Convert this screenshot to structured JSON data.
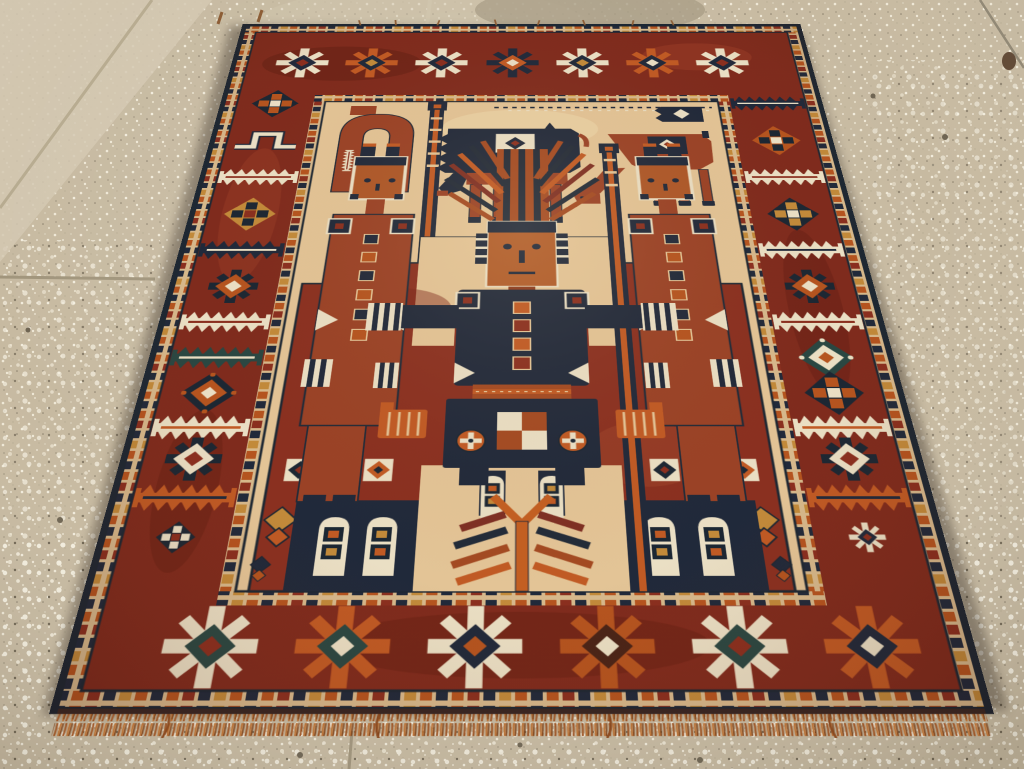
{
  "scene": {
    "type": "photograph",
    "subject": "Antique tribal pictorial rug displayed on a speckled terrazzo floor",
    "description": "A red-ground hand-knotted pictorial rug, seen in perspective with its lower edge nearest the camera, lying on a beige terrazzo concrete floor",
    "floor": {
      "material": "terrazzo concrete",
      "appearance": "beige ground densely flecked with small light stone chips",
      "features": [
        "diagonal grout seam at upper left",
        "horizontal seam at mid left",
        "diagonal seam at upper right",
        "short seam at lower center",
        "small dark brown stain near upper right corner",
        "smooth lighter patch at upper left"
      ]
    },
    "rug": {
      "description": "Pictorial tribal rug with ivory field, brick-red central panel, figural scene and multiple geometric borders",
      "edges": {
        "selvage": "dark indigo overcast edge",
        "top_fringe": "sparse short tufts",
        "bottom_fringe": "orange-brown knotted fringe"
      },
      "guard_stripes": "rows of small alternating colored squares",
      "main_border": {
        "ground": "brick red",
        "top_row": "seven eight-armed snowflake stars",
        "bottom_row": "six large snowflake stars in ivory, orange and teal",
        "side_columns": "stacked serrated comb bars, diamond rosettes, hooked meanders, eight-point stars and diamond medallions"
      },
      "field": {
        "ground": "ivory",
        "upper_scene": {
          "left_motif": "rust arch with white comb",
          "animals": [
            "dark indigo horse with ivory saddle blanket and rust legs",
            "rust quadruped with indigo saddle patch and lowered head"
          ],
          "detail": "dotted warp line across the top of the field"
        },
        "central_panel": {
          "ground": "deep brick red",
          "central_figure": "frontal standing figure with orange face, radiating feather headdress, dark indigo torso with orange button column, outstretched arms with striped cuffs, checkered apron and two orange wheel rosettes",
          "attendants": "two flanking box-headed figures in rust robes grasping vertical striped poles",
          "poles": "two ladder-like striped standards",
          "lower_scene": "ivory arched boot shapes on indigo bands flanking a central tree with mirrored herringbone fronds",
          "scatter_motifs": [
            "ivory framed diamond squares",
            "gold double diamonds",
            "small indigo quatrefoil dots"
          ]
        }
      }
    }
  },
  "palette": {
    "floor_base": "#c7baa1",
    "floor_smooth": "#d6cbb4",
    "floor_speckle": "#efe8d6",
    "floor_speckle_dark": "#847a66",
    "grout": "#9c9178",
    "stain": "#5e4632",
    "selvage": "#1c2733",
    "guard_ground": "#d7b98c",
    "border_red": "#7f2b1d",
    "border_dark": "#621f13",
    "border_light": "#a2432a",
    "field_cream": "#e3c496",
    "panel_red": "#8a3020",
    "figure_rust": "#9a4226",
    "indigo": "#1c2733",
    "orange": "#b5541f",
    "orange_bright": "#c05a24",
    "gold": "#c28a3a",
    "ivory": "#eadfc4",
    "teal": "#2a4742",
    "fringe": "#a85c28",
    "shadow": "#2a211a"
  }
}
